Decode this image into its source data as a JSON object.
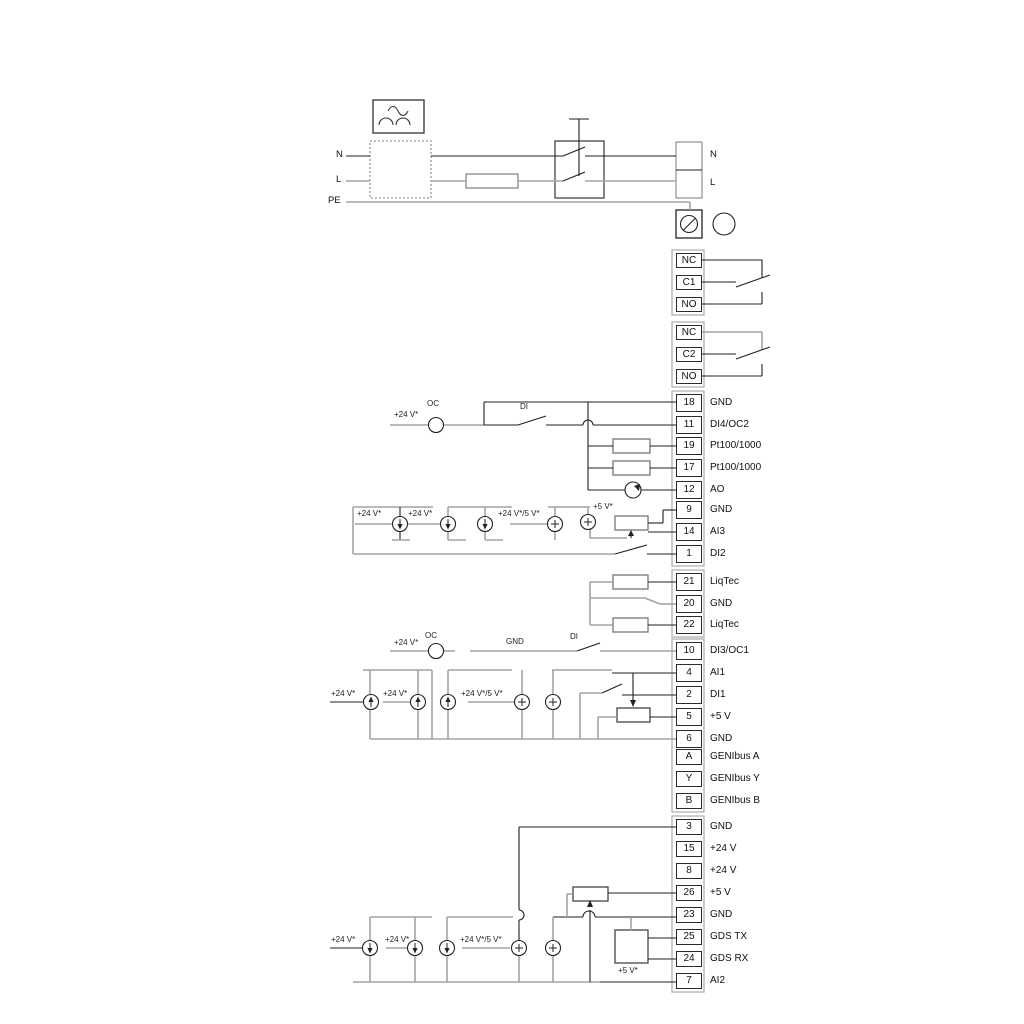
{
  "diagram": {
    "power": {
      "input_labels": {
        "n": "N",
        "l": "L",
        "pe": "PE"
      },
      "output_labels": {
        "n": "N",
        "l": "L"
      }
    },
    "relays": [
      {
        "terminals": [
          "NC",
          "C1",
          "NO"
        ]
      },
      {
        "terminals": [
          "NC",
          "C2",
          "NO"
        ]
      }
    ],
    "terminal_groups": [
      {
        "name": "io-group-1",
        "terminals": [
          {
            "id": "18",
            "label": "GND"
          },
          {
            "id": "11",
            "label": "DI4/OC2"
          },
          {
            "id": "19",
            "label": "Pt100/1000"
          },
          {
            "id": "17",
            "label": "Pt100/1000"
          },
          {
            "id": "12",
            "label": "AO"
          },
          {
            "id": "9",
            "label": "GND"
          },
          {
            "id": "14",
            "label": "AI3"
          },
          {
            "id": "1",
            "label": "DI2"
          }
        ]
      },
      {
        "name": "liqtec-group",
        "terminals": [
          {
            "id": "21",
            "label": "LiqTec"
          },
          {
            "id": "20",
            "label": "GND"
          },
          {
            "id": "22",
            "label": "LiqTec"
          }
        ]
      },
      {
        "name": "io-group-2",
        "terminals": [
          {
            "id": "10",
            "label": "DI3/OC1"
          },
          {
            "id": "4",
            "label": "AI1"
          },
          {
            "id": "2",
            "label": "DI1"
          },
          {
            "id": "5",
            "label": "+5 V"
          },
          {
            "id": "6",
            "label": "GND"
          },
          {
            "id": "A",
            "label": "GENIbus A"
          },
          {
            "id": "Y",
            "label": "GENIbus Y"
          },
          {
            "id": "B",
            "label": "GENIbus B"
          }
        ]
      },
      {
        "name": "io-group-3",
        "terminals": [
          {
            "id": "3",
            "label": "GND"
          },
          {
            "id": "15",
            "label": "+24 V"
          },
          {
            "id": "8",
            "label": "+24 V"
          },
          {
            "id": "26",
            "label": "+5 V"
          },
          {
            "id": "23",
            "label": "GND"
          },
          {
            "id": "25",
            "label": "GDS TX"
          },
          {
            "id": "24",
            "label": "GDS RX"
          },
          {
            "id": "7",
            "label": "AI2"
          }
        ]
      }
    ],
    "annotations": {
      "v24": "+24 V*",
      "v24v5": "+24 V*/5 V*",
      "v5": "+5 V*",
      "oc": "OC",
      "di": "DI",
      "gnd": "GND"
    },
    "colors": {
      "wire_dark": "#1f1f1f",
      "wire_light": "#a3a3a3"
    }
  }
}
